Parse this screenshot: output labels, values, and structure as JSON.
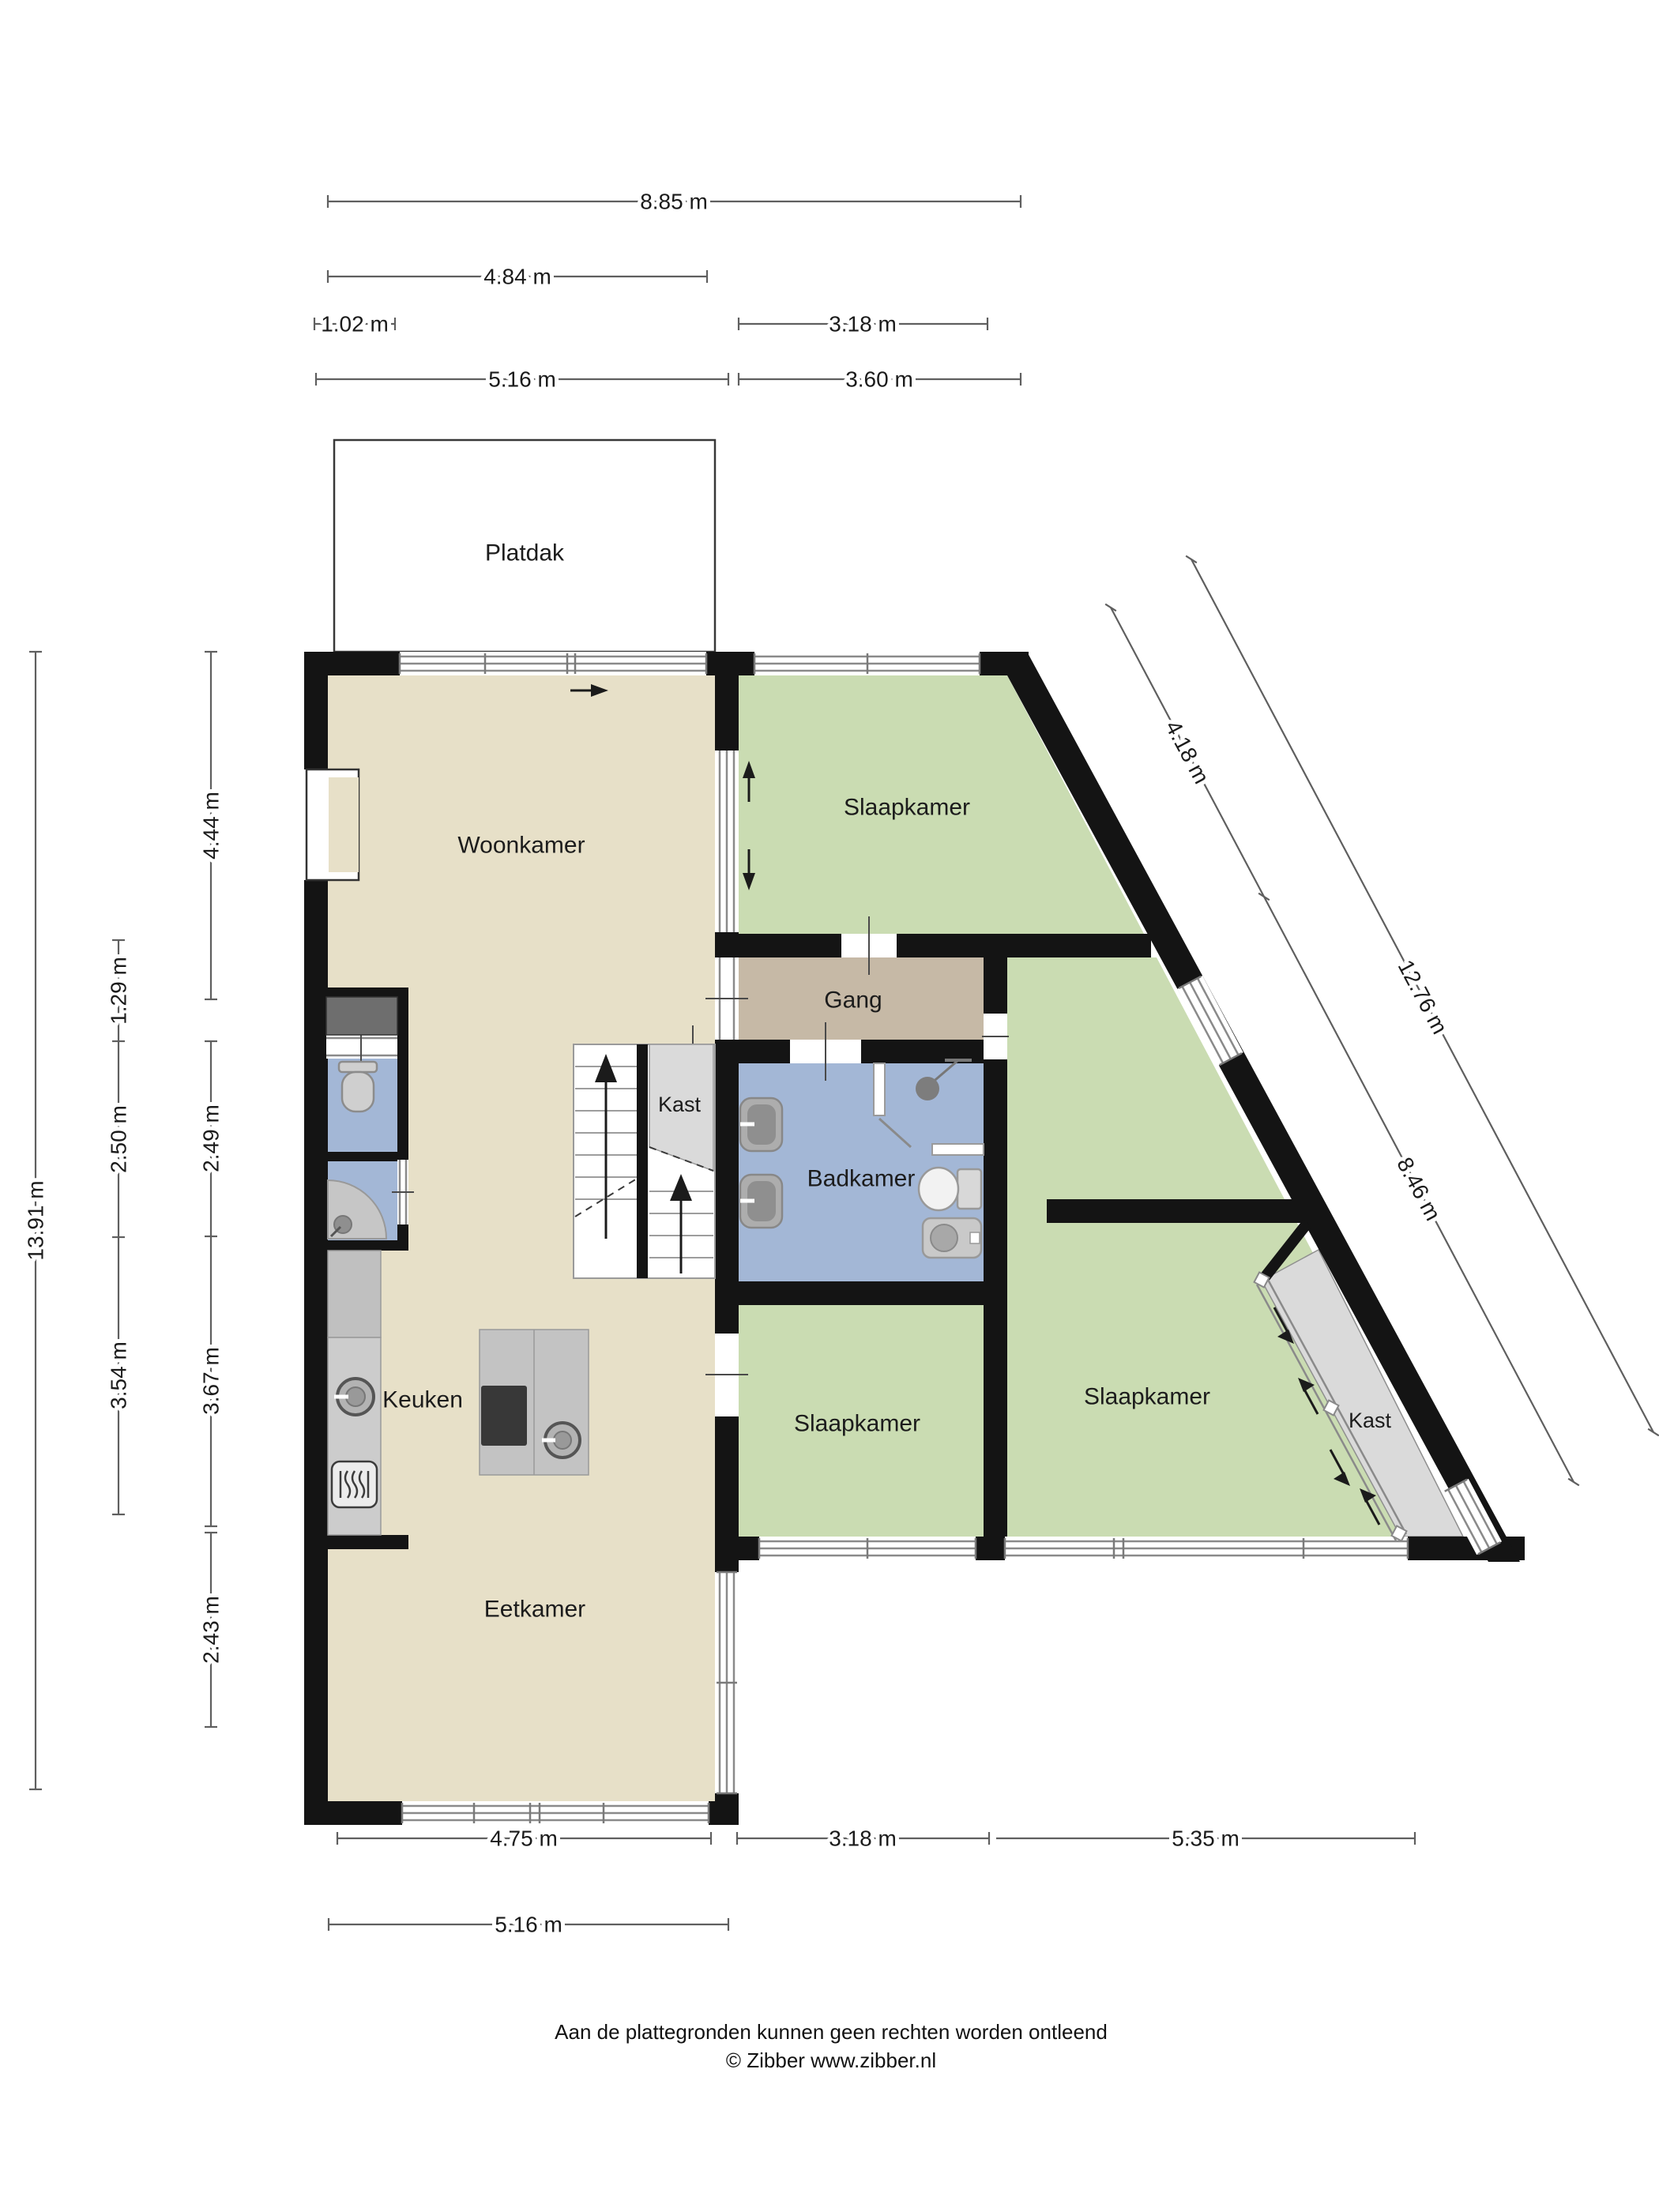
{
  "footer": {
    "line1": "Aan de plattegronden kunnen geen rechten worden ontleend",
    "line2": "© Zibber www.zibber.nl"
  },
  "rooms": {
    "platdak": "Platdak",
    "woonkamer": "Woonkamer",
    "slaapkamer_top": "Slaapkamer",
    "gang": "Gang",
    "kast_mid": "Kast",
    "badkamer": "Badkamer",
    "keuken": "Keuken",
    "eetkamer": "Eetkamer",
    "slaapkamer_bottom": "Slaapkamer",
    "slaapkamer_right": "Slaapkamer",
    "kast_right": "Kast"
  },
  "dims": {
    "top": [
      "8.85 m",
      "4.84 m",
      "1.02 m",
      "3.18 m",
      "5.16 m",
      "3.60 m"
    ],
    "left": [
      "13.91 m",
      "1.29 m",
      "2.50 m",
      "3.54 m",
      "4.44 m",
      "2.49 m",
      "3.67 m",
      "2.43 m"
    ],
    "bottom": [
      "4.75 m",
      "3.18 m",
      "5.35 m",
      "5.16 m"
    ],
    "diagonal": [
      "4.18 m",
      "8.46 m",
      "12.76 m"
    ]
  },
  "colors": {
    "wall": "#141414",
    "floor": "#e7e0c8",
    "bedroom": "#cadcb2",
    "bath": "#a3b7d6",
    "hall": "#c6b9a6",
    "closet": "#dadada",
    "counter": "#c0c0c0",
    "counter2": "#cccccc",
    "island": "#c3c3c3",
    "cooktop": "#383838",
    "cabinet": "#6e6e6e",
    "platdak": "#ffffff"
  },
  "icons": [
    "stairs-up-arrow-icon",
    "toilet-icon",
    "bidet-icon",
    "sink-icon",
    "shower-head-icon",
    "corner-shower-icon",
    "oven-icon",
    "cooktop-icon",
    "sliding-door-arrow-icon",
    "window-icon",
    "door-opening-icon"
  ]
}
